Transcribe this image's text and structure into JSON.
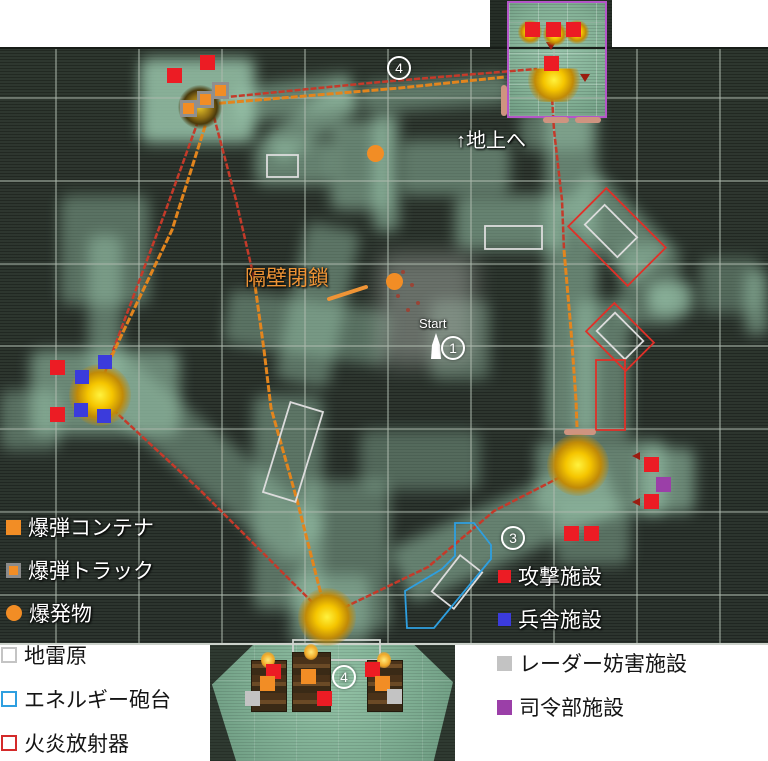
{
  "annotations": {
    "to_surface": "↑地上へ",
    "bulkhead_closed": "隔壁閉鎖",
    "start_label": "Start"
  },
  "waypoints": [
    {
      "num": "4",
      "x": 398,
      "y": 67
    },
    {
      "num": "1",
      "x": 452,
      "y": 347
    },
    {
      "num": "3",
      "x": 512,
      "y": 537
    },
    {
      "num": "4",
      "x": 343,
      "y": 676
    }
  ],
  "legend": {
    "on_map_left": [
      {
        "id": "bomb-container",
        "label": "爆弾コンテナ",
        "swatch": "orange-square"
      },
      {
        "id": "bomb-truck",
        "label": "爆弾トラック",
        "swatch": "orange-square-gray-border"
      },
      {
        "id": "explosive",
        "label": "爆発物",
        "swatch": "orange-circle"
      }
    ],
    "on_white_left": [
      {
        "id": "minefield",
        "label": "地雷原",
        "swatch": "white-outline-square"
      },
      {
        "id": "energy-turret",
        "label": "エネルギー砲台",
        "swatch": "blue-outline-square"
      },
      {
        "id": "flamethrower",
        "label": "火炎放射器",
        "swatch": "red-outline-square"
      }
    ],
    "on_map_right": [
      {
        "id": "attack-facility",
        "label": "攻撃施設",
        "swatch": "red-square"
      },
      {
        "id": "barracks-facility",
        "label": "兵舎施設",
        "swatch": "blue-square"
      }
    ],
    "on_white_right": [
      {
        "id": "radar-jamming-facility",
        "label": "レーダー妨害施設",
        "swatch": "gray-square"
      },
      {
        "id": "hq-facility",
        "label": "司令部施設",
        "swatch": "purple-square"
      }
    ]
  },
  "markers": [
    {
      "type": "red",
      "x": 167,
      "y": 68
    },
    {
      "type": "red",
      "x": 200,
      "y": 55
    },
    {
      "type": "red",
      "x": 525,
      "y": 22
    },
    {
      "type": "red",
      "x": 546,
      "y": 22
    },
    {
      "type": "red",
      "x": 566,
      "y": 22
    },
    {
      "type": "red",
      "x": 544,
      "y": 56
    },
    {
      "type": "red",
      "x": 50,
      "y": 360
    },
    {
      "type": "red",
      "x": 50,
      "y": 407
    },
    {
      "type": "red",
      "x": 644,
      "y": 457
    },
    {
      "type": "red",
      "x": 644,
      "y": 494
    },
    {
      "type": "red",
      "x": 564,
      "y": 526
    },
    {
      "type": "red",
      "x": 584,
      "y": 526
    },
    {
      "type": "red",
      "x": 266,
      "y": 664
    },
    {
      "type": "red",
      "x": 317,
      "y": 691
    },
    {
      "type": "red",
      "x": 365,
      "y": 662
    },
    {
      "type": "blue",
      "x": 75,
      "y": 370
    },
    {
      "type": "blue",
      "x": 98,
      "y": 355
    },
    {
      "type": "blue",
      "x": 74,
      "y": 403
    },
    {
      "type": "blue",
      "x": 97,
      "y": 409
    },
    {
      "type": "truck",
      "x": 180,
      "y": 100
    },
    {
      "type": "truck",
      "x": 197,
      "y": 91
    },
    {
      "type": "truck",
      "x": 212,
      "y": 82
    },
    {
      "type": "orange",
      "x": 260,
      "y": 676
    },
    {
      "type": "orange",
      "x": 301,
      "y": 669
    },
    {
      "type": "orange",
      "x": 375,
      "y": 676
    },
    {
      "type": "gray",
      "x": 245,
      "y": 691
    },
    {
      "type": "gray",
      "x": 387,
      "y": 689
    },
    {
      "type": "purple",
      "x": 656,
      "y": 477
    },
    {
      "type": "explosive",
      "x": 367,
      "y": 145
    },
    {
      "type": "explosive",
      "x": 386,
      "y": 273
    }
  ],
  "bases": [
    {
      "x": 200,
      "y": 107,
      "r": 17,
      "kind": "dark"
    },
    {
      "x": 100,
      "y": 395,
      "r": 24,
      "kind": "bright"
    },
    {
      "x": 578,
      "y": 465,
      "r": 24,
      "kind": "bright"
    },
    {
      "x": 327,
      "y": 617,
      "r": 22,
      "kind": "bright"
    },
    {
      "x": 554,
      "y": 80,
      "r": 20,
      "kind": "dome"
    },
    {
      "x": 530,
      "y": 32,
      "r": 9,
      "kind": "small"
    },
    {
      "x": 555,
      "y": 34,
      "r": 9,
      "kind": "small"
    },
    {
      "x": 577,
      "y": 32,
      "r": 9,
      "kind": "small"
    }
  ],
  "trucks": [
    {
      "x": 251,
      "y": 660,
      "w": 34,
      "h": 50
    },
    {
      "x": 292,
      "y": 652,
      "w": 37,
      "h": 58
    },
    {
      "x": 367,
      "y": 660,
      "w": 34,
      "h": 50
    }
  ],
  "colors": {
    "attack_red": "#ec1c24",
    "barracks_blue": "#3b3bdc",
    "bomb_orange": "#f28d25",
    "radar_gray": "#c3c3c3",
    "hq_purple": "#9b3fa8",
    "route_red": "#c43a2a",
    "route_orange": "#e2851e",
    "zone_blue": "#2e9fe0",
    "zone_red": "#e03028",
    "zone_white": "#e0e0e0",
    "building_purple": "#b455c8",
    "bulkhead_salmon": "#cf9480"
  }
}
